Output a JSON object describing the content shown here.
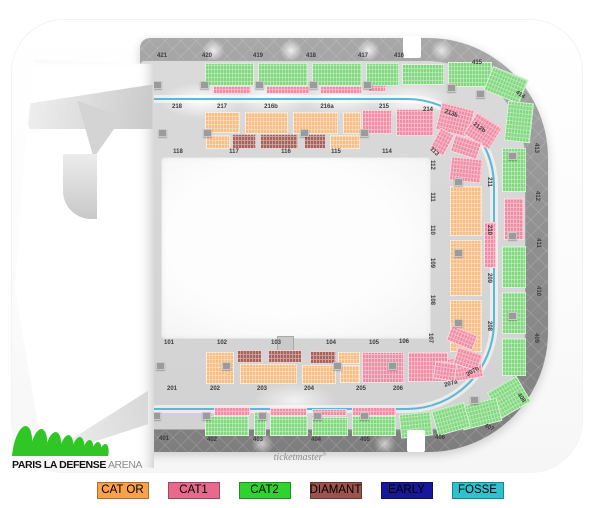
{
  "branding": {
    "arena_logo_text_bold": "PARIS LA DEFENSE",
    "arena_logo_text_light": "ARENA",
    "logo_green": "#2fc626",
    "watermark": "ticketmaster",
    "watermark_mark": "®"
  },
  "legend": {
    "items": [
      {
        "label": "CAT OR",
        "color": "#f9a24b"
      },
      {
        "label": "CAT1",
        "color": "#e8698c"
      },
      {
        "label": "CAT2",
        "color": "#2fd32f"
      },
      {
        "label": "DIAMANT",
        "color": "#9b534d"
      },
      {
        "label": "EARLY",
        "color": "#17179c"
      },
      {
        "label": "FOSSE",
        "color": "#2cc3ce"
      }
    ]
  },
  "map": {
    "palette": {
      "g": "#82d87f",
      "pk": "#ef8da4",
      "o": "#f6bd85",
      "d": "#a8625c"
    },
    "fosse_ring_color": "#5ab8d9",
    "section_labels": [
      {
        "t": "421",
        "x": 162,
        "y": 56
      },
      {
        "t": "420",
        "x": 207,
        "y": 56
      },
      {
        "t": "419",
        "x": 258,
        "y": 56
      },
      {
        "t": "418",
        "x": 311,
        "y": 56
      },
      {
        "t": "417",
        "x": 363,
        "y": 56
      },
      {
        "t": "416",
        "x": 399,
        "y": 56
      },
      {
        "t": "415",
        "x": 477,
        "y": 63
      },
      {
        "t": "414",
        "x": 520,
        "y": 95,
        "r": 35
      },
      {
        "t": "413",
        "x": 536,
        "y": 148,
        "r": 90
      },
      {
        "t": "412",
        "x": 537,
        "y": 196,
        "r": 90
      },
      {
        "t": "411",
        "x": 538,
        "y": 243,
        "r": 90
      },
      {
        "t": "410",
        "x": 538,
        "y": 291,
        "r": 90
      },
      {
        "t": "409",
        "x": 536,
        "y": 338,
        "r": 90
      },
      {
        "t": "408",
        "x": 521,
        "y": 398,
        "r": 55
      },
      {
        "t": "407",
        "x": 489,
        "y": 428,
        "r": 25
      },
      {
        "t": "406",
        "x": 440,
        "y": 438
      },
      {
        "t": "405",
        "x": 365,
        "y": 440
      },
      {
        "t": "404",
        "x": 316,
        "y": 440
      },
      {
        "t": "403",
        "x": 258,
        "y": 440
      },
      {
        "t": "402",
        "x": 212,
        "y": 440
      },
      {
        "t": "401",
        "x": 164,
        "y": 439
      },
      {
        "t": "218",
        "x": 177,
        "y": 107
      },
      {
        "t": "217",
        "x": 222,
        "y": 107
      },
      {
        "t": "216b",
        "x": 271,
        "y": 107
      },
      {
        "t": "216a",
        "x": 327,
        "y": 107
      },
      {
        "t": "215",
        "x": 384,
        "y": 107
      },
      {
        "t": "214",
        "x": 428,
        "y": 110
      },
      {
        "t": "213b",
        "x": 451,
        "y": 114,
        "r": 20
      },
      {
        "t": "212b",
        "x": 479,
        "y": 128,
        "r": 35
      },
      {
        "t": "211",
        "x": 489,
        "y": 182,
        "r": 90
      },
      {
        "t": "210",
        "x": 489,
        "y": 230,
        "r": 90
      },
      {
        "t": "209",
        "x": 489,
        "y": 278,
        "r": 90
      },
      {
        "t": "208",
        "x": 489,
        "y": 326,
        "r": 90
      },
      {
        "t": "207b",
        "x": 473,
        "y": 372,
        "r": -30
      },
      {
        "t": "207a",
        "x": 451,
        "y": 384,
        "r": -15
      },
      {
        "t": "206",
        "x": 398,
        "y": 389
      },
      {
        "t": "205",
        "x": 361,
        "y": 389
      },
      {
        "t": "204",
        "x": 309,
        "y": 389
      },
      {
        "t": "203",
        "x": 262,
        "y": 389
      },
      {
        "t": "202",
        "x": 215,
        "y": 389
      },
      {
        "t": "201",
        "x": 172,
        "y": 389
      },
      {
        "t": "118",
        "x": 178,
        "y": 152
      },
      {
        "t": "117",
        "x": 234,
        "y": 152
      },
      {
        "t": "116",
        "x": 286,
        "y": 152
      },
      {
        "t": "115",
        "x": 336,
        "y": 152
      },
      {
        "t": "114",
        "x": 387,
        "y": 152
      },
      {
        "t": "113",
        "x": 434,
        "y": 152,
        "r": 45
      },
      {
        "t": "112",
        "x": 432,
        "y": 165,
        "r": 90
      },
      {
        "t": "111",
        "x": 432,
        "y": 197,
        "r": 90
      },
      {
        "t": "110",
        "x": 432,
        "y": 230,
        "r": 90
      },
      {
        "t": "109",
        "x": 432,
        "y": 263,
        "r": 90
      },
      {
        "t": "108",
        "x": 432,
        "y": 300,
        "r": 90
      },
      {
        "t": "107",
        "x": 430,
        "y": 338,
        "r": 90
      },
      {
        "t": "101",
        "x": 169,
        "y": 343
      },
      {
        "t": "102",
        "x": 222,
        "y": 343
      },
      {
        "t": "103",
        "x": 276,
        "y": 343
      },
      {
        "t": "104",
        "x": 331,
        "y": 343
      },
      {
        "t": "105",
        "x": 374,
        "y": 343
      },
      {
        "t": "106",
        "x": 404,
        "y": 342
      }
    ],
    "blocks": [
      [
        205,
        63,
        49,
        23,
        "g"
      ],
      [
        258,
        63,
        50,
        23,
        "g"
      ],
      [
        312,
        63,
        50,
        23,
        "g"
      ],
      [
        366,
        63,
        33,
        23,
        "g"
      ],
      [
        402,
        64,
        42,
        21,
        "g"
      ],
      [
        448,
        62,
        44,
        25,
        "g"
      ],
      [
        487,
        72,
        38,
        26,
        "g",
        22
      ],
      [
        506,
        102,
        26,
        40,
        "g",
        6
      ],
      [
        213,
        86,
        38,
        8,
        "pk"
      ],
      [
        266,
        86,
        44,
        8,
        "pk"
      ],
      [
        320,
        86,
        42,
        8,
        "pk"
      ],
      [
        368,
        85,
        18,
        7,
        "pk"
      ],
      [
        502,
        148,
        24,
        44,
        "g"
      ],
      [
        504,
        198,
        20,
        42,
        "pk"
      ],
      [
        502,
        246,
        24,
        42,
        "g"
      ],
      [
        502,
        292,
        24,
        42,
        "g"
      ],
      [
        502,
        338,
        24,
        38,
        "g"
      ],
      [
        492,
        382,
        34,
        30,
        "g",
        -30
      ],
      [
        460,
        402,
        40,
        24,
        "g",
        -14
      ],
      [
        205,
        416,
        44,
        20,
        "g"
      ],
      [
        254,
        412,
        12,
        24,
        "g"
      ],
      [
        270,
        416,
        38,
        20,
        "g"
      ],
      [
        312,
        417,
        36,
        19,
        "g"
      ],
      [
        352,
        416,
        44,
        20,
        "g"
      ],
      [
        400,
        413,
        32,
        24,
        "g",
        -6
      ],
      [
        434,
        406,
        34,
        26,
        "g",
        -16
      ],
      [
        214,
        407,
        36,
        9,
        "pk"
      ],
      [
        270,
        408,
        37,
        8,
        "pk"
      ],
      [
        312,
        409,
        35,
        7,
        "pk"
      ],
      [
        352,
        407,
        44,
        9,
        "pk"
      ],
      [
        205,
        112,
        35,
        21,
        "o"
      ],
      [
        245,
        112,
        43,
        22,
        "o"
      ],
      [
        293,
        112,
        45,
        22,
        "o"
      ],
      [
        343,
        112,
        18,
        22,
        "o"
      ],
      [
        206,
        135,
        24,
        14,
        "o"
      ],
      [
        330,
        135,
        30,
        14,
        "o"
      ],
      [
        232,
        134,
        24,
        15,
        "d"
      ],
      [
        260,
        134,
        38,
        15,
        "d"
      ],
      [
        304,
        134,
        22,
        15,
        "d"
      ],
      [
        362,
        110,
        30,
        24,
        "pk"
      ],
      [
        396,
        109,
        38,
        27,
        "pk"
      ],
      [
        438,
        106,
        34,
        28,
        "pk",
        14
      ],
      [
        468,
        118,
        30,
        26,
        "pk",
        32
      ],
      [
        452,
        138,
        28,
        18,
        "pk",
        18
      ],
      [
        450,
        158,
        32,
        24,
        "pk",
        6
      ],
      [
        450,
        186,
        32,
        50,
        "o"
      ],
      [
        450,
        240,
        32,
        56,
        "o"
      ],
      [
        450,
        300,
        32,
        52,
        "o"
      ],
      [
        484,
        222,
        12,
        46,
        "pk"
      ],
      [
        448,
        356,
        34,
        24,
        "pk",
        -10
      ],
      [
        434,
        130,
        16,
        24,
        "pk",
        28
      ],
      [
        237,
        350,
        25,
        13,
        "d"
      ],
      [
        268,
        350,
        34,
        13,
        "d"
      ],
      [
        310,
        351,
        26,
        13,
        "d"
      ],
      [
        206,
        352,
        28,
        32,
        "o"
      ],
      [
        240,
        364,
        57,
        20,
        "o"
      ],
      [
        302,
        365,
        34,
        19,
        "o"
      ],
      [
        338,
        352,
        22,
        12,
        "o"
      ],
      [
        340,
        365,
        20,
        18,
        "o"
      ],
      [
        362,
        352,
        42,
        31,
        "pk"
      ],
      [
        408,
        352,
        40,
        30,
        "pk"
      ],
      [
        448,
        330,
        28,
        16,
        "pk",
        22
      ],
      [
        455,
        350,
        26,
        18,
        "pk",
        18
      ],
      [
        434,
        362,
        22,
        18,
        "pk",
        8
      ]
    ],
    "squares": [
      [
        153,
        81
      ],
      [
        200,
        81
      ],
      [
        255,
        81
      ],
      [
        309,
        81
      ],
      [
        363,
        81
      ],
      [
        447,
        84
      ],
      [
        158,
        129
      ],
      [
        203,
        129
      ],
      [
        300,
        129
      ],
      [
        360,
        129
      ],
      [
        156,
        362
      ],
      [
        222,
        362
      ],
      [
        333,
        362
      ],
      [
        388,
        362
      ],
      [
        152,
        412
      ],
      [
        202,
        412
      ],
      [
        258,
        412
      ],
      [
        313,
        412
      ],
      [
        360,
        412
      ],
      [
        454,
        178
      ],
      [
        454,
        249
      ],
      [
        454,
        319
      ],
      [
        508,
        152
      ],
      [
        508,
        232
      ],
      [
        508,
        312
      ],
      [
        476,
        90
      ],
      [
        470,
        396
      ]
    ],
    "notches": [
      [
        403,
        36,
        18,
        22
      ],
      [
        407,
        430,
        18,
        22
      ]
    ]
  }
}
